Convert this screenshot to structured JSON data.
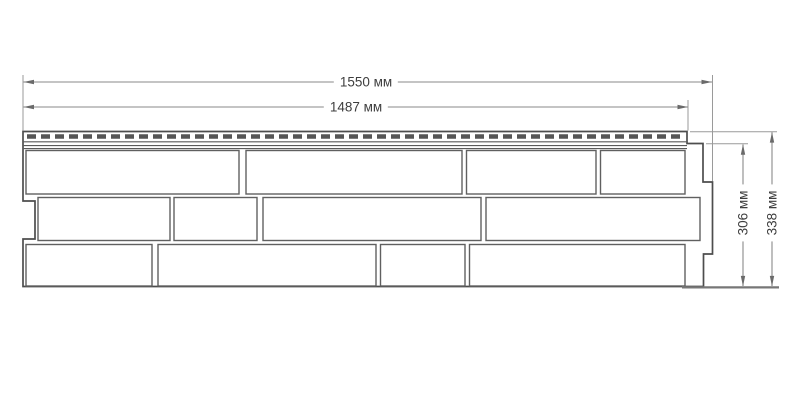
{
  "diagram": {
    "units": "мм",
    "labels": {
      "width_total": "1550 мм",
      "width_nail_strip": "1487 мм",
      "height_face": "306 мм",
      "height_total": "338 мм"
    },
    "values": {
      "width_total_mm": 1550,
      "width_nail_strip_mm": 1487,
      "height_face_mm": 306,
      "height_total_mm": 338
    },
    "colors": {
      "background": "#ffffff",
      "panel_outline": "#4d4d4d",
      "brick_line": "#606060",
      "slot_fill": "#555555",
      "dimension_line": "#8a8a8a",
      "label_text": "#3e3e3e"
    }
  }
}
